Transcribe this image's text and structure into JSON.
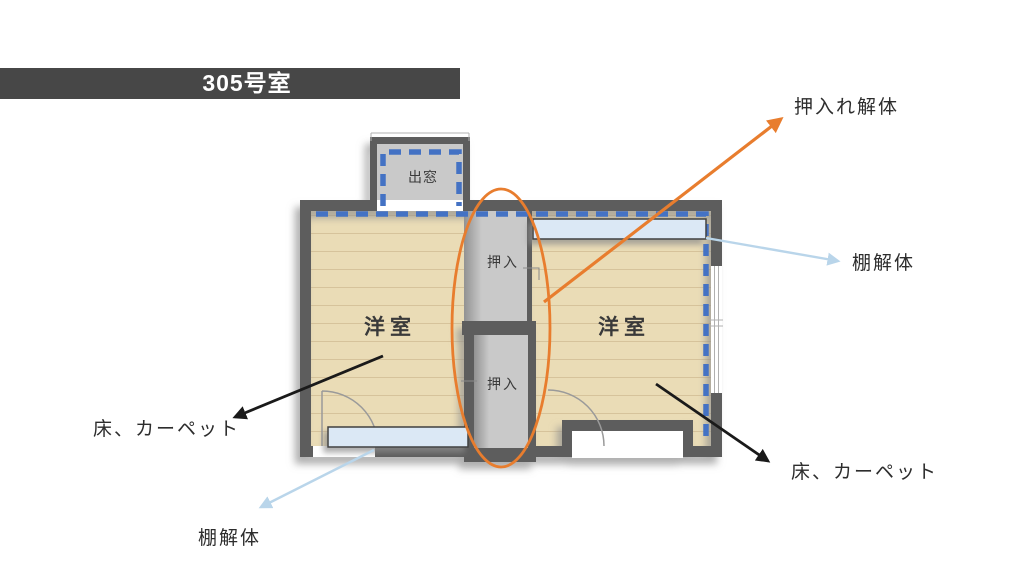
{
  "header": {
    "title": "305号室"
  },
  "floorplan": {
    "left_room": {
      "label": "洋室"
    },
    "right_room": {
      "label": "洋室"
    },
    "upper_closet": {
      "label": "押入"
    },
    "lower_closet": {
      "label": "押入"
    },
    "bay_window": {
      "label": "出窓"
    }
  },
  "annotations": {
    "closet_demolition": {
      "label": "押入れ解体"
    },
    "shelf_demolition_right": {
      "label": "棚解体"
    },
    "shelf_demolition_left": {
      "label": "棚解体"
    },
    "floor_carpet_left": {
      "label": "床、カーペット"
    },
    "floor_carpet_right": {
      "label": "床、カーペット"
    }
  },
  "colors": {
    "header_bg": "#474747",
    "header_text": "#ffffff",
    "wall": "#5d5d5d",
    "floor": "#eadcb6",
    "floor_line": "#d6c39b",
    "closet_fill": "#c9c9c9",
    "closet_shade": "#929292",
    "shelf_fill": "#dbe8f5",
    "dashed_line": "#4472c4",
    "highlight_orange": "#e87d2e",
    "arrow_light_blue": "#b9d5ea",
    "arrow_black": "#1a1a1a",
    "label_text": "#2d2d2d"
  }
}
